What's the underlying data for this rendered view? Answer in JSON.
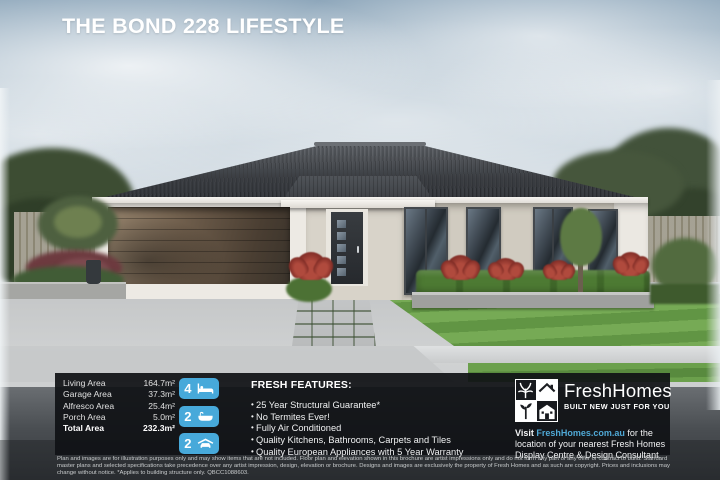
{
  "title": "THE BOND 228 LIFESTYLE",
  "house_sign": "H",
  "areas": {
    "rows": [
      {
        "label": "Living Area",
        "value": "164.7m²"
      },
      {
        "label": "Garage Area",
        "value": "37.3m²"
      },
      {
        "label": "Alfresco Area",
        "value": "25.4m²"
      },
      {
        "label": "Porch Area",
        "value": "5.0m²"
      }
    ],
    "total": {
      "label": "Total Area",
      "value": "232.3m²"
    }
  },
  "badges": [
    {
      "count": "4",
      "icon": "bed-icon"
    },
    {
      "count": "2",
      "icon": "bath-icon"
    },
    {
      "count": "2",
      "icon": "garage-icon"
    }
  ],
  "features": {
    "heading": "FRESH FEATURES:",
    "items": [
      "25 Year Structural Guarantee*",
      "No Termites Ever!",
      "Fully Air Conditioned",
      "Quality Kitchens, Bathrooms, Carpets and Tiles",
      "Quality European Appliances with 5 Year Warranty"
    ]
  },
  "brand": {
    "name": "FreshHomes",
    "tagline": "BUILT NEW JUST FOR YOU",
    "visit_prefix": "Visit ",
    "visit_link": "FreshHomes.com.au",
    "visit_suffix": " for the location of your nearest Fresh Homes Display Centre & Design Consultant."
  },
  "disclaimer": "Plan and images are for illustration purposes only and may show items that are not included. Floor plan and elevation shown in this brochure are artist impressions only and do not form any part of any offer or contract to build. Standard master plans and selected specifications take precedence over any artist impression, design, elevation or brochure. Designs and images are exclusively the property of Fresh Homes and as such are copyright. Prices and inclusions may change without notice. *Applies to building structure only. QBCC1088603.",
  "colors": {
    "accent_blue": "#47a9da",
    "link_blue": "#4fa8d5",
    "panel": "rgba(16,18,22,0.93)"
  }
}
